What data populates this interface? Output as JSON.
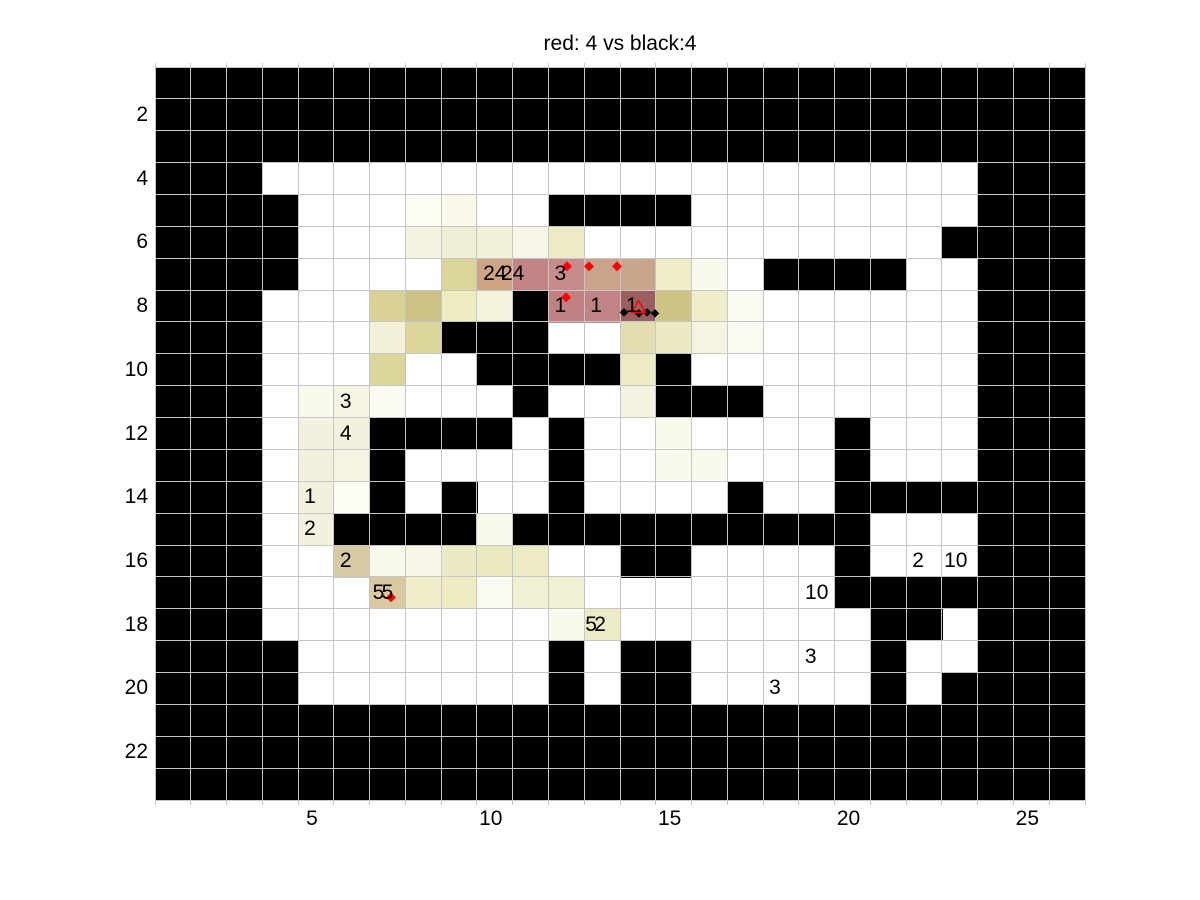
{
  "title": "red: 4 vs black:4",
  "chart_data": {
    "type": "heatmap",
    "title": "red: 4 vs black:4",
    "xlabel": "",
    "ylabel": "",
    "x_ticks": [
      5,
      10,
      15,
      20,
      25
    ],
    "y_ticks": [
      2,
      4,
      6,
      8,
      10,
      12,
      14,
      16,
      18,
      20,
      22
    ],
    "x_range": [
      0.5,
      26.5
    ],
    "y_range": [
      0.5,
      23.5
    ],
    "grid_cols": 26,
    "grid_rows": 23,
    "grid_on": true,
    "grid_line_color": "#C6C6C6",
    "legend": {
      "#": "wall (black cell)",
      ".": "free (white cell)",
      "letters_digits": "heat-tinted cells"
    },
    "palette": {
      "#": "#000000",
      ".": "#FFFFFF",
      "a": "#FDFCF2",
      "b": "#FAF8EA",
      "c": "#F4F1DE",
      "d": "#F0EDD5",
      "e": "#F2EFDA",
      "f": "#F7F5E6",
      "g": "#EDEAC6",
      "h": "#DBD59B",
      "i": "#CDA585",
      "j": "#C28484",
      "k": "#C68C8C",
      "l": "#C9A38C",
      "m": "#CAA58E",
      "n": "#EFEDC9",
      "o": "#D9D195",
      "p": "#CCC286",
      "q": "#EEEBC1",
      "r": "#F4F2DC",
      "s": "#BF8181",
      "t": "#C08484",
      "u": "#9C5F5F",
      "v": "#CDC384",
      "w": "#D7C9A3",
      "x": "#D8C99E",
      "y": "#F4F1D9",
      "z": "#DCD59C",
      "0": "#E2DEB2",
      "1": "#ECEAC4",
      "2": "#FAF9EE",
      "3": "#EBE9BF",
      "4": "#EDEBC4",
      "5": "#F2F0D2",
      "6": "#F5F3E1",
      "7": "#FBFAF2",
      "8": "#F4F2E0",
      "9": "#F3F1DD"
    },
    "grid": [
      "##########################",
      "##########################",
      "##########################",
      "###....................###",
      "####...ab..####........###",
      "####...cdefg..........####",
      "####....hijklmn2.####..###",
      "###...opqr#stuvn7......###",
      "###...yz###..0167......###",
      "###...z..####4#........###",
      "###.267...#..8###......###",
      "###.99####.#..2....#...###",
      "###.96#....#..22...#...###",
      "###.9a#.#..#....#..#######",
      "###.9####2##########...###",
      "###..w2f134..##....#...###",
      "###...xnq755.......#######",
      "###........24.......##.###",
      "####.......#.##.....#..###",
      "####.......#.##.....#.####",
      "##########################",
      "##########################",
      "##########################"
    ],
    "cell_labels": [
      {
        "col": 10,
        "row": 7,
        "text": "24",
        "dx": 0
      },
      {
        "col": 10.5,
        "row": 7,
        "text": "24",
        "dx": 0
      },
      {
        "col": 12,
        "row": 7,
        "text": "3",
        "dx": -6
      },
      {
        "col": 12,
        "row": 8,
        "text": "1",
        "dx": -6
      },
      {
        "col": 13,
        "row": 8,
        "text": "1",
        "dx": -6
      },
      {
        "col": 14,
        "row": 8,
        "text": "1",
        "dx": -6
      },
      {
        "col": 6,
        "row": 11,
        "text": "3",
        "dx": -6
      },
      {
        "col": 6,
        "row": 12,
        "text": "4",
        "dx": -6
      },
      {
        "col": 5,
        "row": 14,
        "text": "1",
        "dx": -6
      },
      {
        "col": 5,
        "row": 15,
        "text": "2",
        "dx": -6
      },
      {
        "col": 6,
        "row": 16,
        "text": "2",
        "dx": -6
      },
      {
        "col": 7,
        "row": 17,
        "text": "5",
        "dx": -9
      },
      {
        "col": 7,
        "row": 17,
        "text": "5",
        "dx": 0
      },
      {
        "col": 13,
        "row": 18,
        "text": "5",
        "dx": -11
      },
      {
        "col": 13,
        "row": 18,
        "text": "2",
        "dx": -2
      },
      {
        "col": 22,
        "row": 16,
        "text": "2",
        "dx": -6
      },
      {
        "col": 23,
        "row": 16,
        "text": "10",
        "dx": -4
      },
      {
        "col": 19,
        "row": 17,
        "text": "10",
        "dx": 0
      },
      {
        "col": 19,
        "row": 19,
        "text": "3",
        "dx": -6
      },
      {
        "col": 18,
        "row": 20,
        "text": "3",
        "dx": -6
      }
    ],
    "markers": {
      "red_color": "#FF0000",
      "black_color": "#000000",
      "red_points_px": [
        [
          567,
          266
        ],
        [
          589,
          266
        ],
        [
          617,
          266
        ],
        [
          566,
          297
        ],
        [
          391,
          597
        ]
      ],
      "black_points_px": [
        [
          624,
          312
        ],
        [
          639,
          313
        ],
        [
          647,
          312
        ],
        [
          655,
          313
        ]
      ],
      "red_triangle_px": {
        "x": 638,
        "y": 306,
        "w": 13,
        "h": 11
      }
    }
  }
}
